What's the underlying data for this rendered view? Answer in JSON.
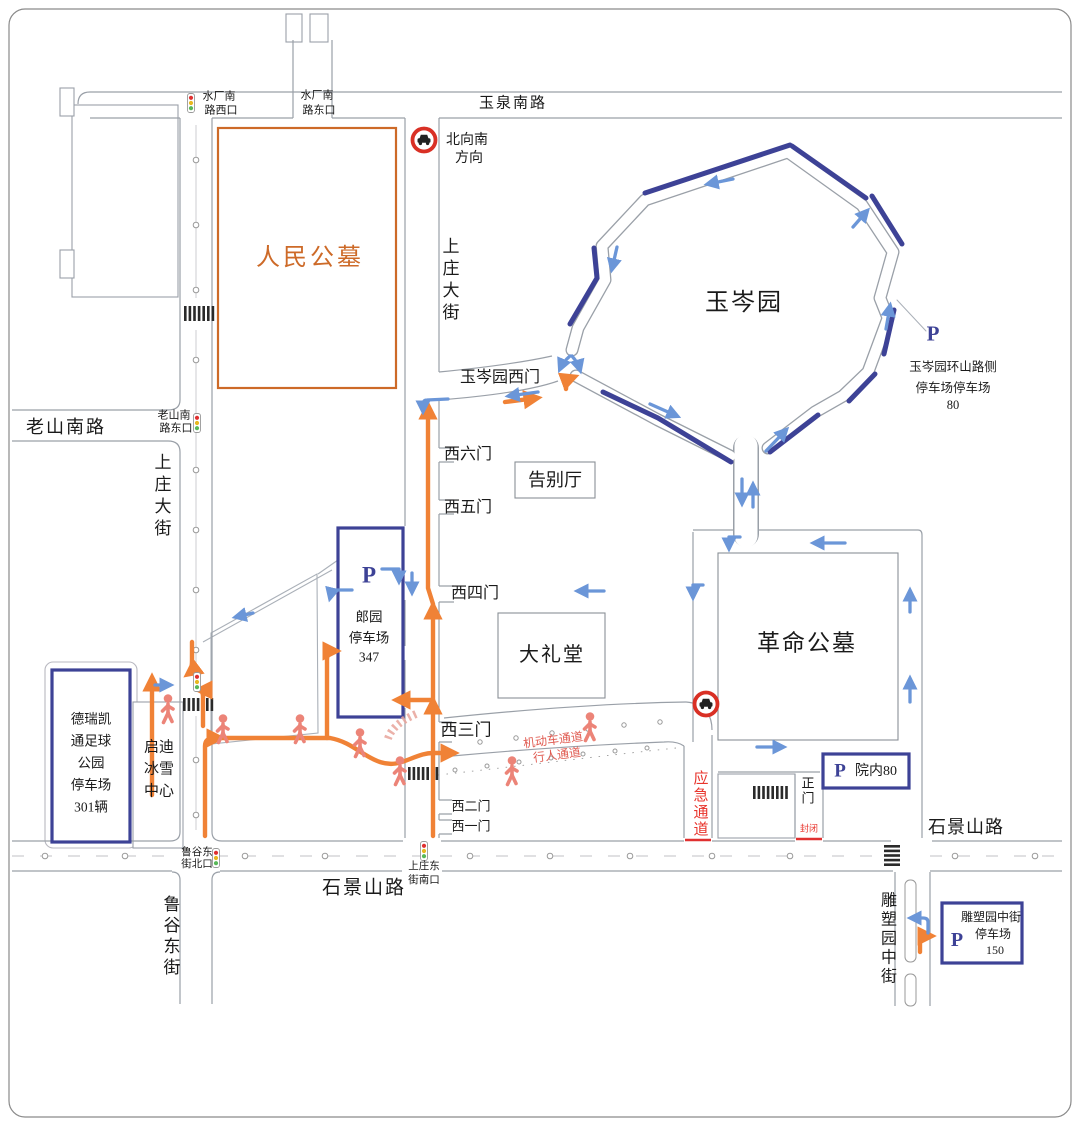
{
  "colors": {
    "orange_route": "#f08236",
    "navy_box": "#3d4296",
    "arrow_blue": "#6b96d8",
    "red_text": "#e8342c",
    "lane_text_pink": "#e05a50",
    "pedestrian": "#ec8478",
    "road_edge_gray": "#9aa0a8",
    "cemetery_orange": "#cd6a28"
  },
  "roads": {
    "yuquan_south": "玉泉南路",
    "shangzhuang_ave_east": "上庄大街",
    "shangzhuang_ave_west": "上庄大街",
    "laoshan_south": "老山南路",
    "shijingshan_bottom": "石景山路",
    "shijingshan_right": "石景山路",
    "lugu_east_st": "鲁谷东街",
    "diaosuyuan_mid_st": "雕塑园中街"
  },
  "intersections": {
    "shuichang_south_west": [
      "水厂南",
      "路西口"
    ],
    "shuichang_south_east": [
      "水厂南",
      "路东口"
    ],
    "laoshan_south_east": [
      "老山南",
      "路东口"
    ],
    "lugu_east_north": [
      "鲁谷东",
      "街北口"
    ],
    "shangzhuang_east_south": [
      "上庄东",
      "街南口"
    ]
  },
  "places": {
    "renmin_cemetery": "人民公墓",
    "yucen_garden": "玉岑园",
    "farewell_hall": "告别厅",
    "great_hall": "大礼堂",
    "revolution_cemetery": "革命公墓",
    "qidi_ice_center": [
      "启迪",
      "冰雪",
      "中心"
    ]
  },
  "gates": {
    "yucen_west_gate": "玉岑园西门",
    "west_gate_6": "西六门",
    "west_gate_5": "西五门",
    "west_gate_4": "西四门",
    "west_gate_3": "西三门",
    "west_gate_2": "西二门",
    "west_gate_1": "西一门",
    "main_gate": "正门"
  },
  "parking": {
    "langyuan": {
      "p": "P",
      "lines": [
        "郎园",
        "停车场",
        "347"
      ]
    },
    "deruikaitong": {
      "lines": [
        "德瑞凯",
        "通足球",
        "公园",
        "停车场",
        "301辆"
      ]
    },
    "huanshan_roadside": {
      "p": "P",
      "lines": [
        "玉岑园环山路侧",
        "停车场停车场",
        "80"
      ]
    },
    "yuannei": {
      "p": "P",
      "label": "院内80"
    },
    "diaosuyuan": {
      "p": "P",
      "lines": [
        "雕塑园中街",
        "停车场",
        "150"
      ]
    }
  },
  "notices": {
    "north_to_south": [
      "北向南",
      "方向"
    ],
    "emergency_channel": "应急通道",
    "closed": "封闭",
    "motor_channel": "机动车通道",
    "pedestrian_channel": "行人通道"
  }
}
